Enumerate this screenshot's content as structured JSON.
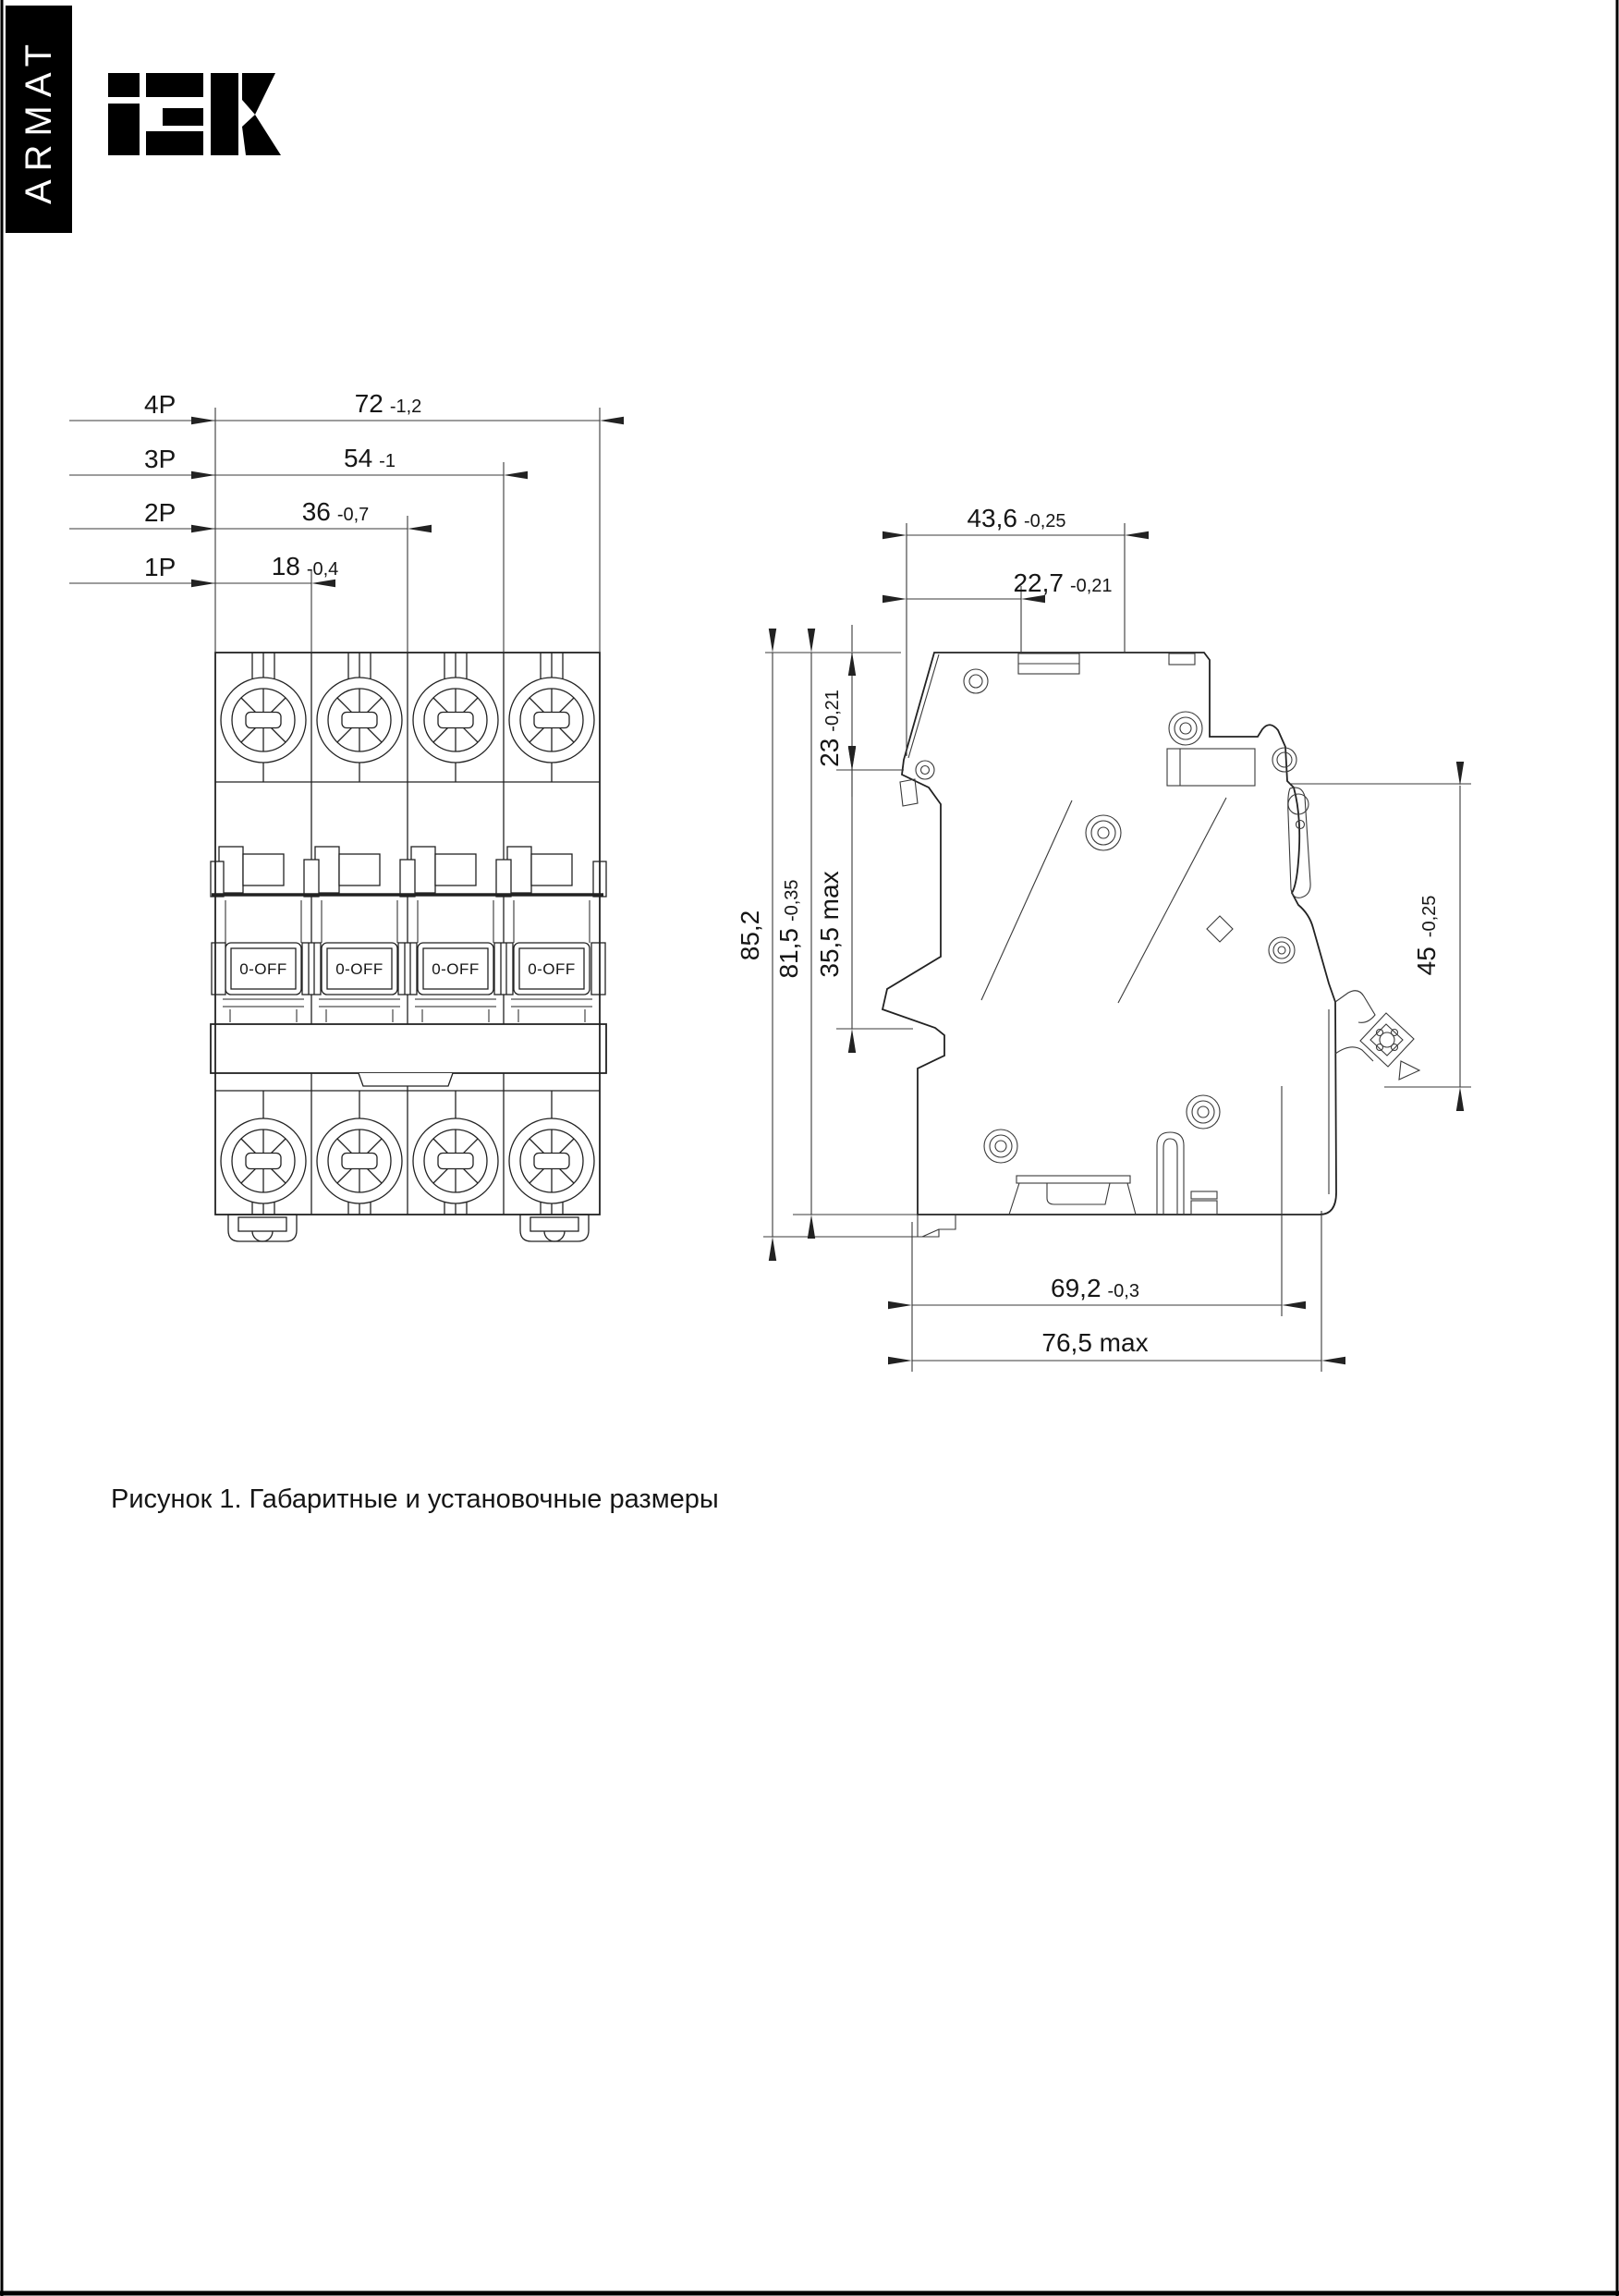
{
  "page": {
    "sidebar_label": "ARMAT",
    "brand": "iEK",
    "caption": "Рисунок 1. Габаритные и установочные размеры"
  },
  "front_view": {
    "toggle_label": "0-OFF",
    "rows": [
      {
        "pole": "4P",
        "value": "72",
        "tol": "-1,2"
      },
      {
        "pole": "3P",
        "value": "54",
        "tol": "-1"
      },
      {
        "pole": "2P",
        "value": "36",
        "tol": "-0,7"
      },
      {
        "pole": "1P",
        "value": "18",
        "tol": "-0,4"
      }
    ]
  },
  "side_view": {
    "dim_width_total": {
      "value": "43,6",
      "tol": "-0,25"
    },
    "dim_width_front": {
      "value": "22,7",
      "tol": "-0,21"
    },
    "dim_height_overall": {
      "value": "85,2"
    },
    "dim_height_body": {
      "value": "81,5",
      "tol": "-0,35"
    },
    "dim_handle": {
      "value": "35,5 max"
    },
    "dim_top_recess": {
      "value": "23",
      "tol": "-0,21"
    },
    "dim_din_face": {
      "value": "45",
      "tol": "-0,25"
    },
    "dim_depth_body": {
      "value": "69,2",
      "tol": "-0,3"
    },
    "dim_depth_total": {
      "value": "76,5 max"
    }
  }
}
